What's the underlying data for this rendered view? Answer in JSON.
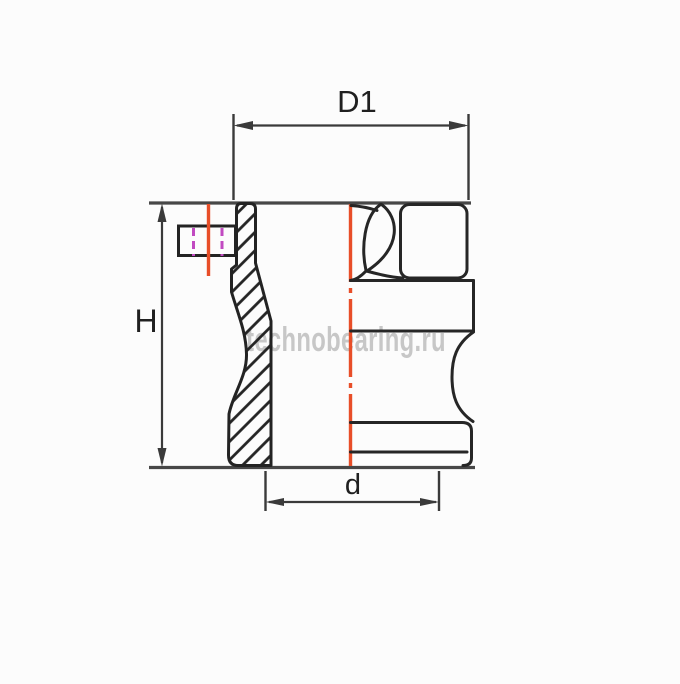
{
  "drawing": {
    "type": "technical-drawing",
    "part": "camlock-male-adapter-half-section",
    "dimensions": {
      "d1_label": "D1",
      "h_label": "H",
      "d_label": "d"
    },
    "watermark": "technobearing.ru",
    "colors": {
      "outline": "#262626",
      "edge": "#474747",
      "dimension": "#3a3a3a",
      "centerline_red": "#e84e28",
      "hidden_magenta": "#c14ac1",
      "watermark_gray": "#c7c7c7",
      "background": "#fcfcfc"
    }
  }
}
